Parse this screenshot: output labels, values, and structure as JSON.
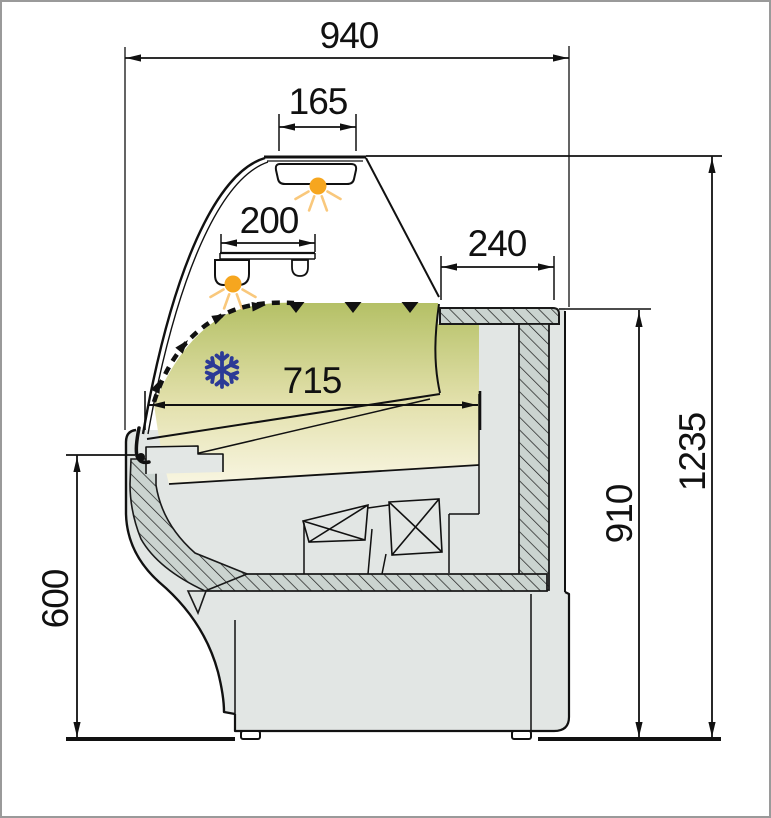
{
  "drawing": {
    "dimensions": {
      "overall_width": "940",
      "light_unit_width": "165",
      "shelf_depth": "200",
      "rear_top_depth": "240",
      "display_area_depth": "715",
      "overall_height": "1235",
      "counter_top_height": "910",
      "front_panel_height": "600"
    },
    "icons": {
      "snowflake": "❄",
      "light": "●",
      "airflow_arrow": "▶",
      "air_down_arrow": "▼"
    },
    "colors": {
      "display_gradient_top": "#b4c065",
      "display_gradient_bottom": "#f8f5e0",
      "light_orange": "#f6a61f",
      "light_ray_orange": "#f9c87c",
      "snowflake_blue": "#3b49ab",
      "panel_grey": "#e2e6e4",
      "hatch_grey": "#cbd4d0",
      "line_black": "#111111",
      "frame_border": "#9a9a9a"
    }
  }
}
